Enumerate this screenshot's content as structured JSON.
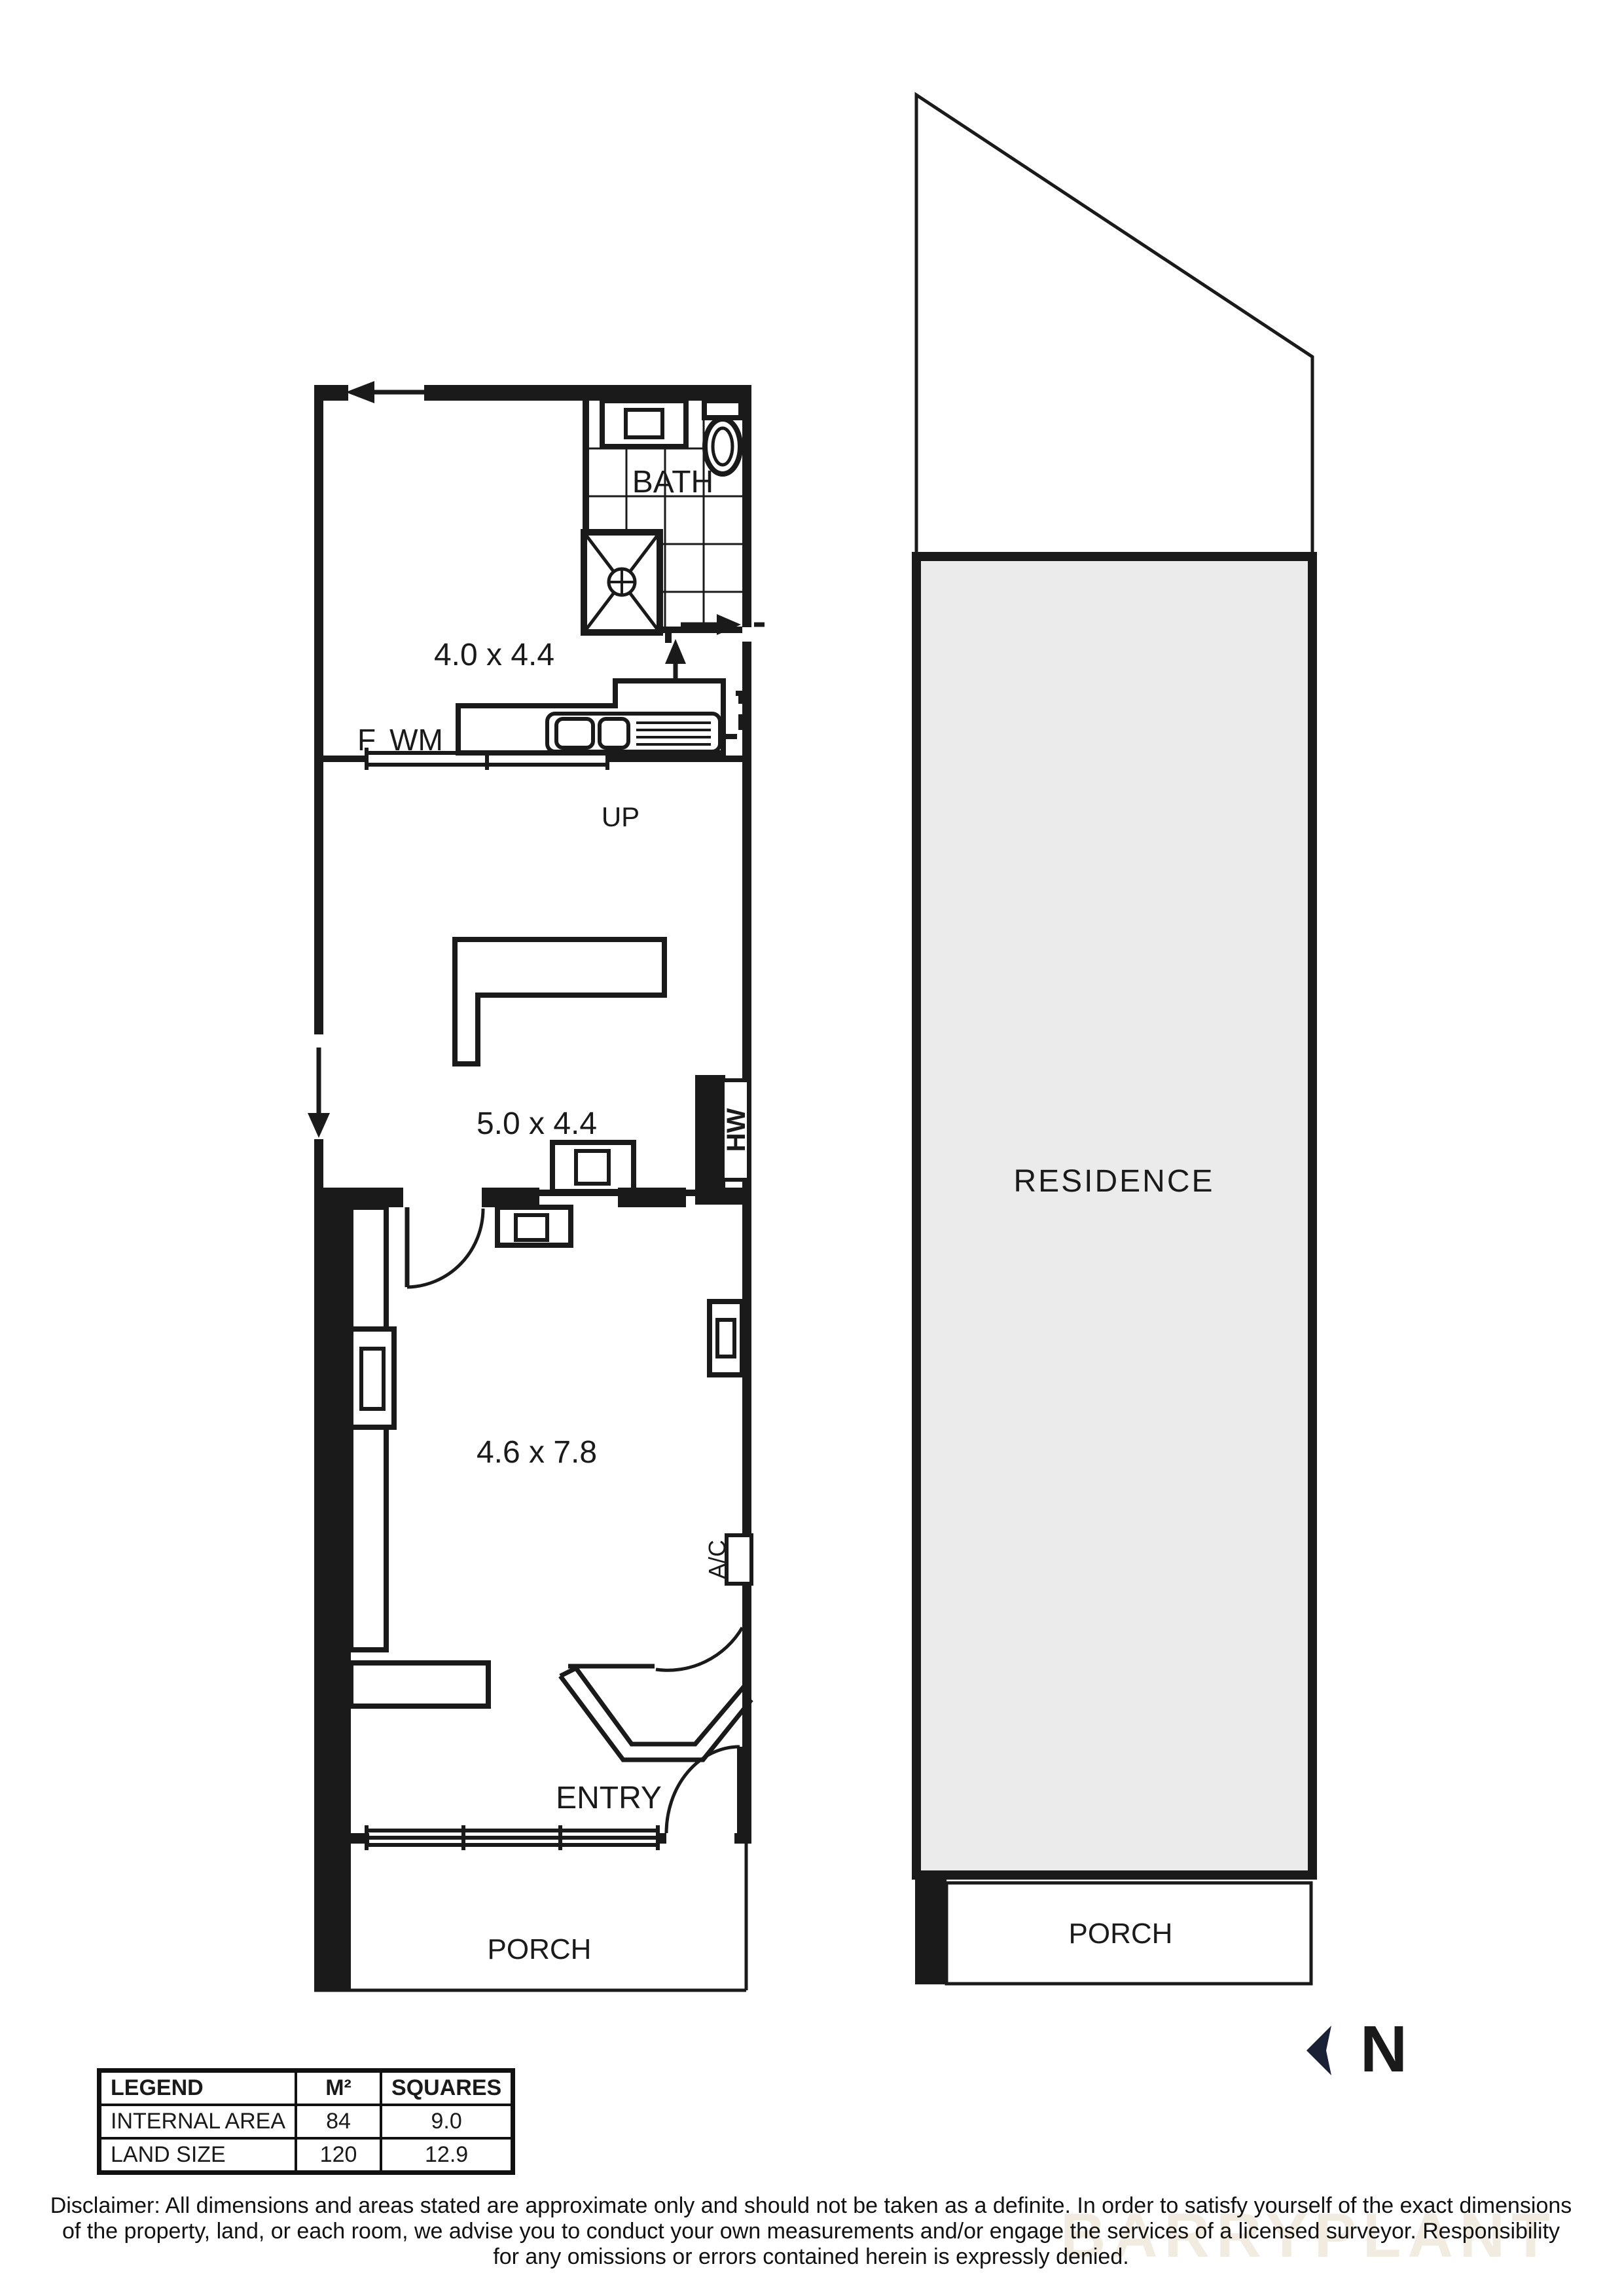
{
  "floor_plan": {
    "bath_label": "BATH",
    "upper_room_dims": "4.0 x 4.4",
    "middle_room_dims": "5.0 x 4.4",
    "front_room_dims": "4.6 x 7.8",
    "entry_label": "ENTRY",
    "porch_label": "PORCH",
    "up_label": "UP",
    "fridge_label": "F",
    "washing_machine_label": "WM",
    "hot_water_label": "HW",
    "air_conditioner_label": "A/C"
  },
  "site_plan": {
    "residence_label": "RESIDENCE",
    "porch_label": "PORCH"
  },
  "compass": {
    "north_label": "N"
  },
  "legend_table": {
    "headers": [
      "LEGEND",
      "M²",
      "SQUARES"
    ],
    "rows": [
      {
        "label": "INTERNAL AREA",
        "m2": "84",
        "squares": "9.0"
      },
      {
        "label": "LAND SIZE",
        "m2": "120",
        "squares": "12.9"
      }
    ]
  },
  "disclaimer": {
    "line1": "Disclaimer: All dimensions and areas stated are approximate only and should not be taken as a definite. In order to satisfy yourself of the exact dimensions",
    "line2": "of the property, land, or each room, we advise you to conduct your own measurements and/or engage the services of a licensed surveyor. Responsibility",
    "line3": "for any omissions or errors contained herein is expressly denied."
  },
  "watermark_text": "BARRYPLANT",
  "colors": {
    "line": "#1a1a1a",
    "residence_fill": "#ebebeb",
    "north": "#1c2236",
    "watermark": "#f1ecdf"
  }
}
